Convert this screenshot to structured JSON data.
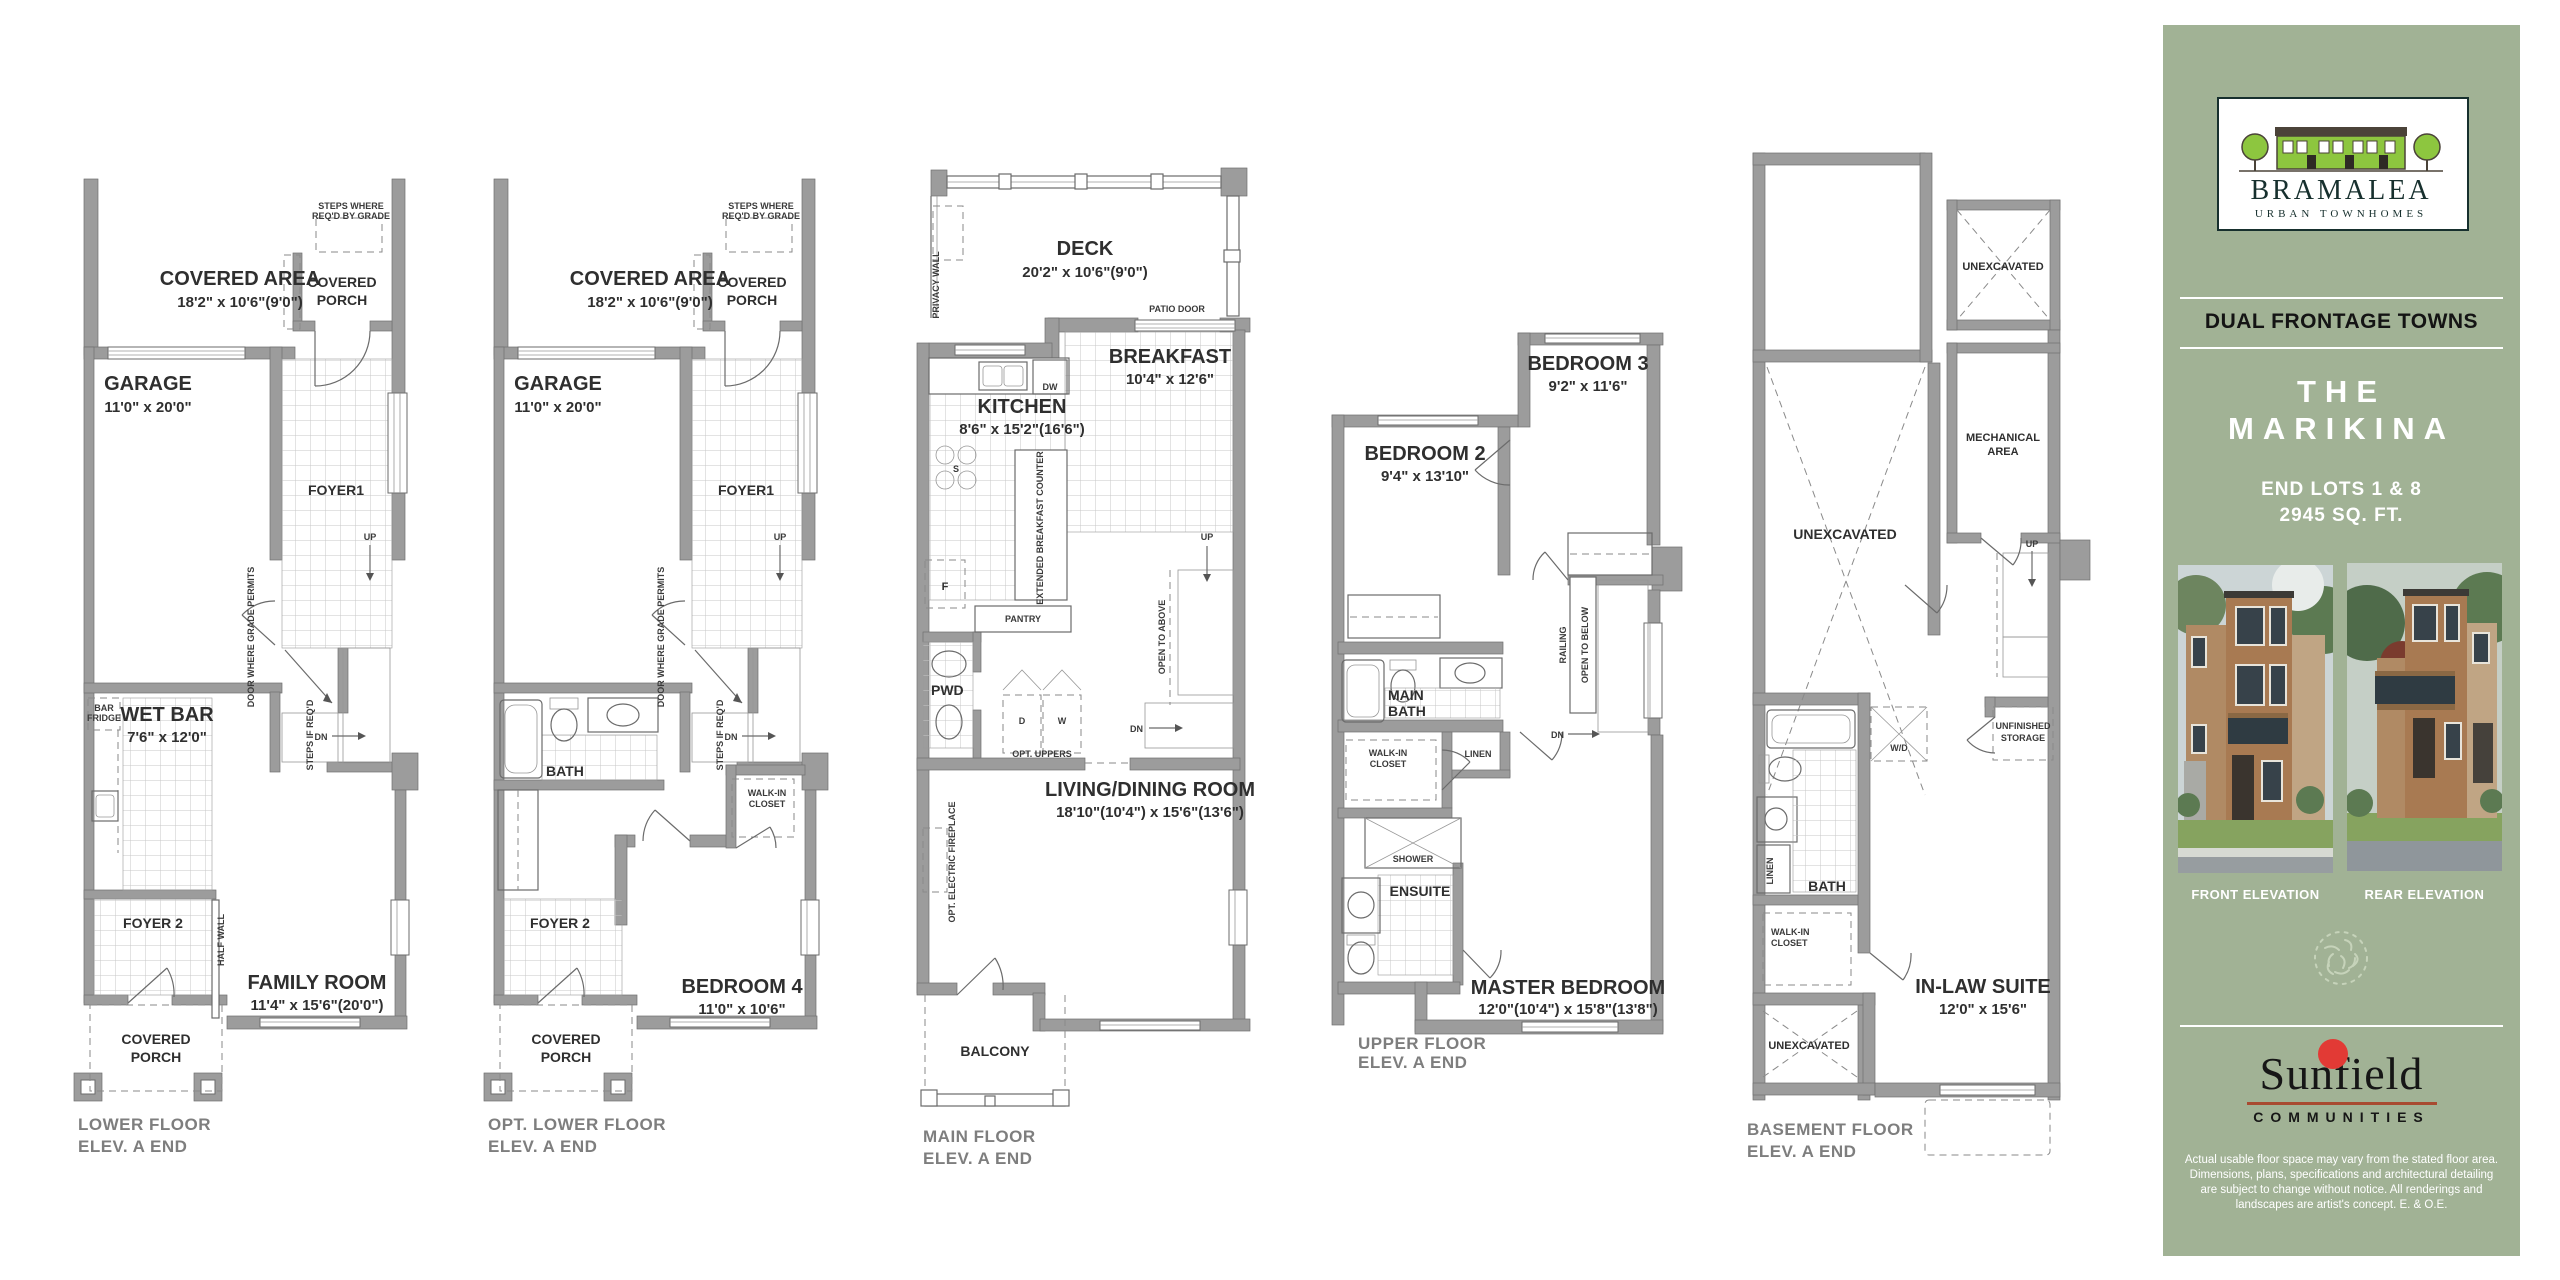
{
  "sidebar": {
    "logo": {
      "brand": "BRAMALEA",
      "tagline": "URBAN TOWNHOMES"
    },
    "banner": "DUAL FRONTAGE TOWNS",
    "title_line1": "THE",
    "title_line2": "MARIKINA",
    "subtitle_line1": "END LOTS 1 & 8",
    "subtitle_line2": "2945 SQ. FT.",
    "front_elevation_label": "FRONT ELEVATION",
    "rear_elevation_label": "REAR ELEVATION",
    "builder": {
      "name": "Sunfield",
      "subname": "COMMUNITIES"
    },
    "disclaimer": "Actual usable floor space may vary from the stated floor area. Dimensions, plans, specifications and architectural detailing are subject to change without notice. All renderings and landscapes are artist's concept. E. & O.E.",
    "colors": {
      "panel_green": "#a1b295",
      "accent_red": "#e23a35",
      "logo_green": "#8dc63f"
    }
  },
  "plans": [
    {
      "name": "lower-floor",
      "caption1": "LOWER FLOOR",
      "caption2": "ELEV. A END",
      "labels": {
        "steps_note1": "STEPS WHERE",
        "steps_note2": "REQ'D BY GRADE",
        "covered_area": "COVERED AREA",
        "covered_area_dim": "18'2\" x 10'6\"(9'0\")",
        "covered_porch1": "COVERED",
        "covered_porch2": "PORCH",
        "garage": "GARAGE",
        "garage_dim": "11'0\" x 20'0\"",
        "foyer1": "FOYER1",
        "up": "UP",
        "dn": "DN",
        "door_note": "DOOR WHERE GRADE PERMITS",
        "steps_req": "STEPS IF REQ'D",
        "bar_fridge1": "BAR",
        "bar_fridge2": "FRIDGE",
        "wet_bar": "WET BAR",
        "wet_bar_dim": "7'6\" x 12'0\"",
        "foyer2": "FOYER 2",
        "half_wall": "HALF WALL",
        "family_room": "FAMILY ROOM",
        "family_room_dim": "11'4\" x 15'6\"(20'0\")",
        "porch_b1": "COVERED",
        "porch_b2": "PORCH"
      }
    },
    {
      "name": "opt-lower-floor",
      "caption1": "OPT. LOWER FLOOR",
      "caption2": "ELEV. A END",
      "labels": {
        "steps_note1": "STEPS WHERE",
        "steps_note2": "REQ'D BY GRADE",
        "covered_area": "COVERED AREA",
        "covered_area_dim": "18'2\" x 10'6\"(9'0\")",
        "covered_porch1": "COVERED",
        "covered_porch2": "PORCH",
        "garage": "GARAGE",
        "garage_dim": "11'0\" x 20'0\"",
        "foyer1": "FOYER1",
        "up": "UP",
        "dn": "DN",
        "door_note": "DOOR WHERE GRADE PERMITS",
        "steps_req": "STEPS IF REQ'D",
        "bath": "BATH",
        "walk_in1": "WALK-IN",
        "walk_in2": "CLOSET",
        "foyer2": "FOYER 2",
        "bedroom4": "BEDROOM 4",
        "bedroom4_dim": "11'0\" x 10'6\"",
        "porch_b1": "COVERED",
        "porch_b2": "PORCH"
      }
    },
    {
      "name": "main-floor",
      "caption1": "MAIN FLOOR",
      "caption2": "ELEV. A END",
      "labels": {
        "deck": "DECK",
        "deck_dim": "20'2\" x 10'6\"(9'0\")",
        "privacy_wall": "PRIVACY WALL",
        "patio_door": "PATIO DOOR",
        "breakfast": "BREAKFAST",
        "breakfast_dim": "10'4\" x 12'6\"",
        "kitchen": "KITCHEN",
        "kitchen_dim": "8'6\" x 15'2\"(16'6\")",
        "dw": "DW",
        "s": "S",
        "f": "F",
        "ext_counter": "EXTENDED BREAKFAST COUNTER",
        "pantry": "PANTRY",
        "pwd": "PWD",
        "d": "D",
        "w": "W",
        "opt_uppers": "OPT. UPPERS",
        "open_above": "OPEN TO ABOVE",
        "up": "UP",
        "dn": "DN",
        "living": "LIVING/DINING ROOM",
        "living_dim": "18'10\"(10'4\") x 15'6\"(13'6\")",
        "fireplace": "OPT. ELECTRIC FIREPLACE",
        "balcony": "BALCONY"
      }
    },
    {
      "name": "upper-floor",
      "caption1": "UPPER FLOOR",
      "caption2": "ELEV. A END",
      "labels": {
        "bedroom2": "BEDROOM 2",
        "bedroom2_dim": "9'4\" x 13'10\"",
        "bedroom3": "BEDROOM 3",
        "bedroom3_dim": "9'2\" x 11'6\"",
        "main_bath1": "MAIN",
        "main_bath2": "BATH",
        "railing": "RAILING",
        "open_below": "OPEN TO BELOW",
        "dn": "DN",
        "walk_in1": "WALK-IN",
        "walk_in2": "CLOSET",
        "linen": "LINEN",
        "shower": "SHOWER",
        "ensuite": "ENSUITE",
        "master": "MASTER BEDROOM",
        "master_dim": "12'0\"(10'4\") x 15'8\"(13'8\")"
      }
    },
    {
      "name": "basement-floor",
      "caption1": "BASEMENT FLOOR",
      "caption2": "ELEV. A END",
      "labels": {
        "unexcavated_top": "UNEXCAVATED",
        "mech1": "MECHANICAL",
        "mech2": "AREA",
        "unexcavated_large": "UNEXCAVATED",
        "up": "UP",
        "wd": "W/D",
        "storage1": "UNFINISHED",
        "storage2": "STORAGE",
        "bath": "BATH",
        "linen": "LINEN",
        "walk_in1": "WALK-IN",
        "walk_in2": "CLOSET",
        "unexcavated_bottom": "UNEXCAVATED",
        "inlaw": "IN-LAW SUITE",
        "inlaw_dim": "12'0\" x 15'6\""
      }
    }
  ]
}
